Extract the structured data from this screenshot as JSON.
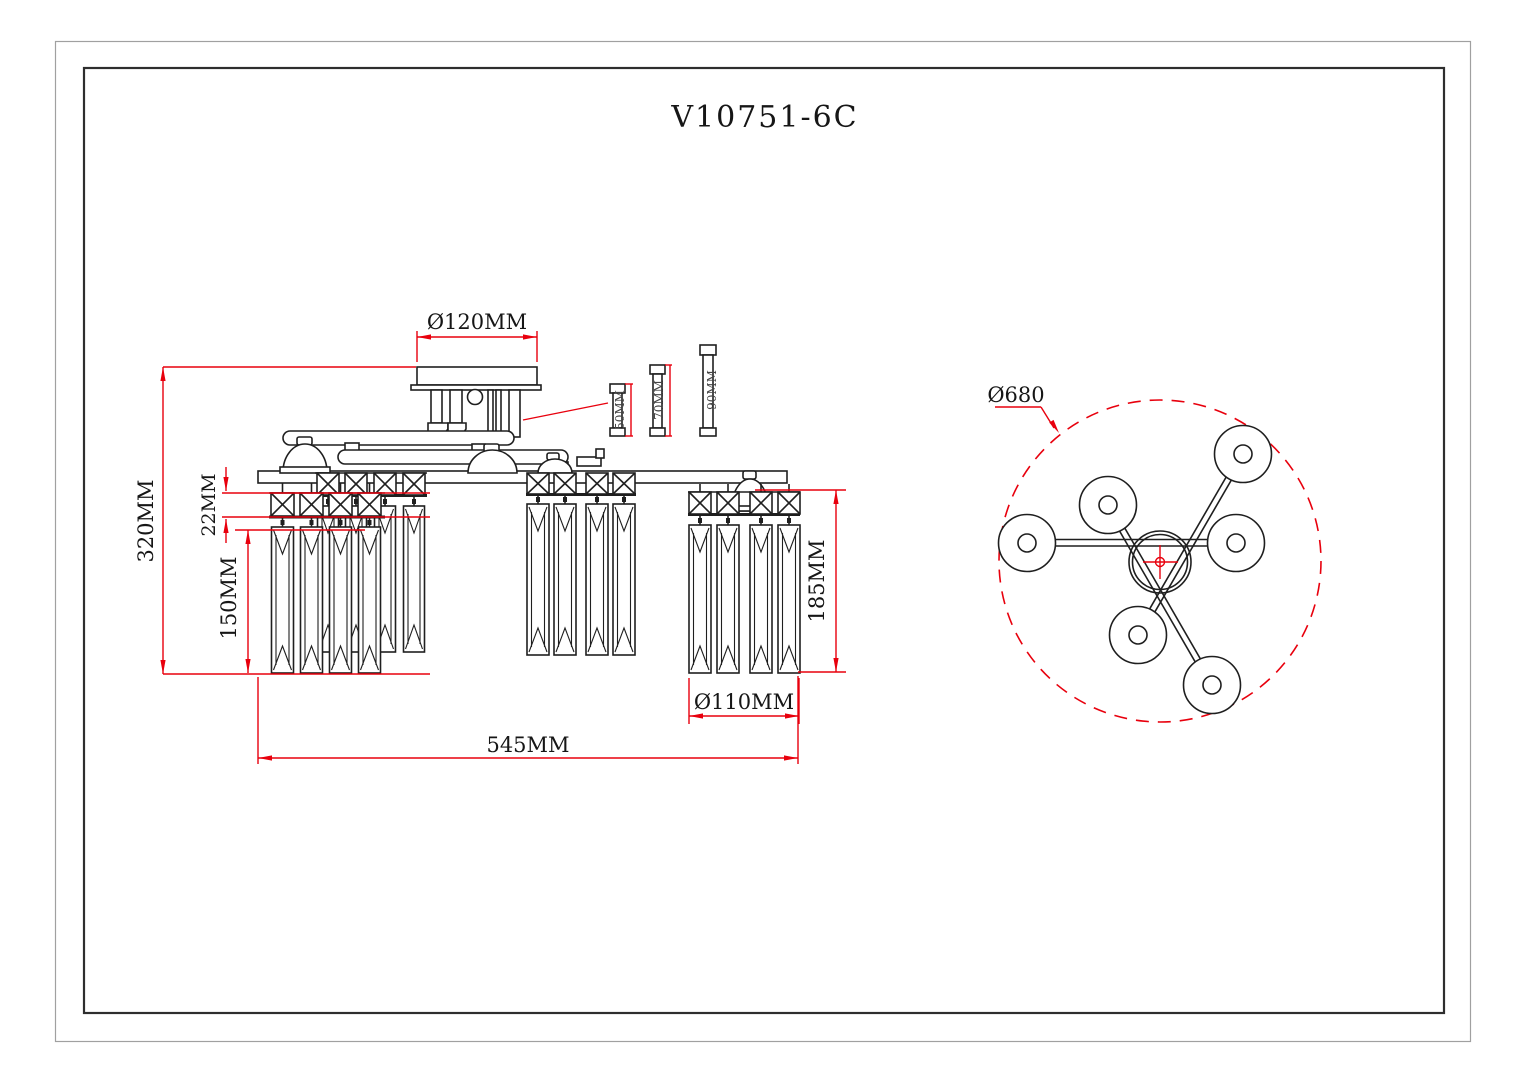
{
  "drawing": {
    "title": "V10751-6C"
  },
  "front_view": {
    "dim_canopy_diameter": "Ø120MM",
    "dim_total_height": "320MM",
    "dim_bead_height": "22MM",
    "dim_prism_length": "150MM",
    "dim_lamp_height": "185MM",
    "dim_lamp_diameter": "Ø110MM",
    "dim_total_width": "545MM",
    "tube_lengths": [
      "50MM",
      "70MM",
      "90MM"
    ]
  },
  "top_view": {
    "dim_overall_diameter": "Ø680",
    "lamp_count": 6
  },
  "colors": {
    "line": "#1f1f1f",
    "dimension_red": "#e8000d",
    "frame_inner": "#2e2e2e",
    "frame_outer": "#a0a0a0",
    "background": "#ffffff"
  }
}
